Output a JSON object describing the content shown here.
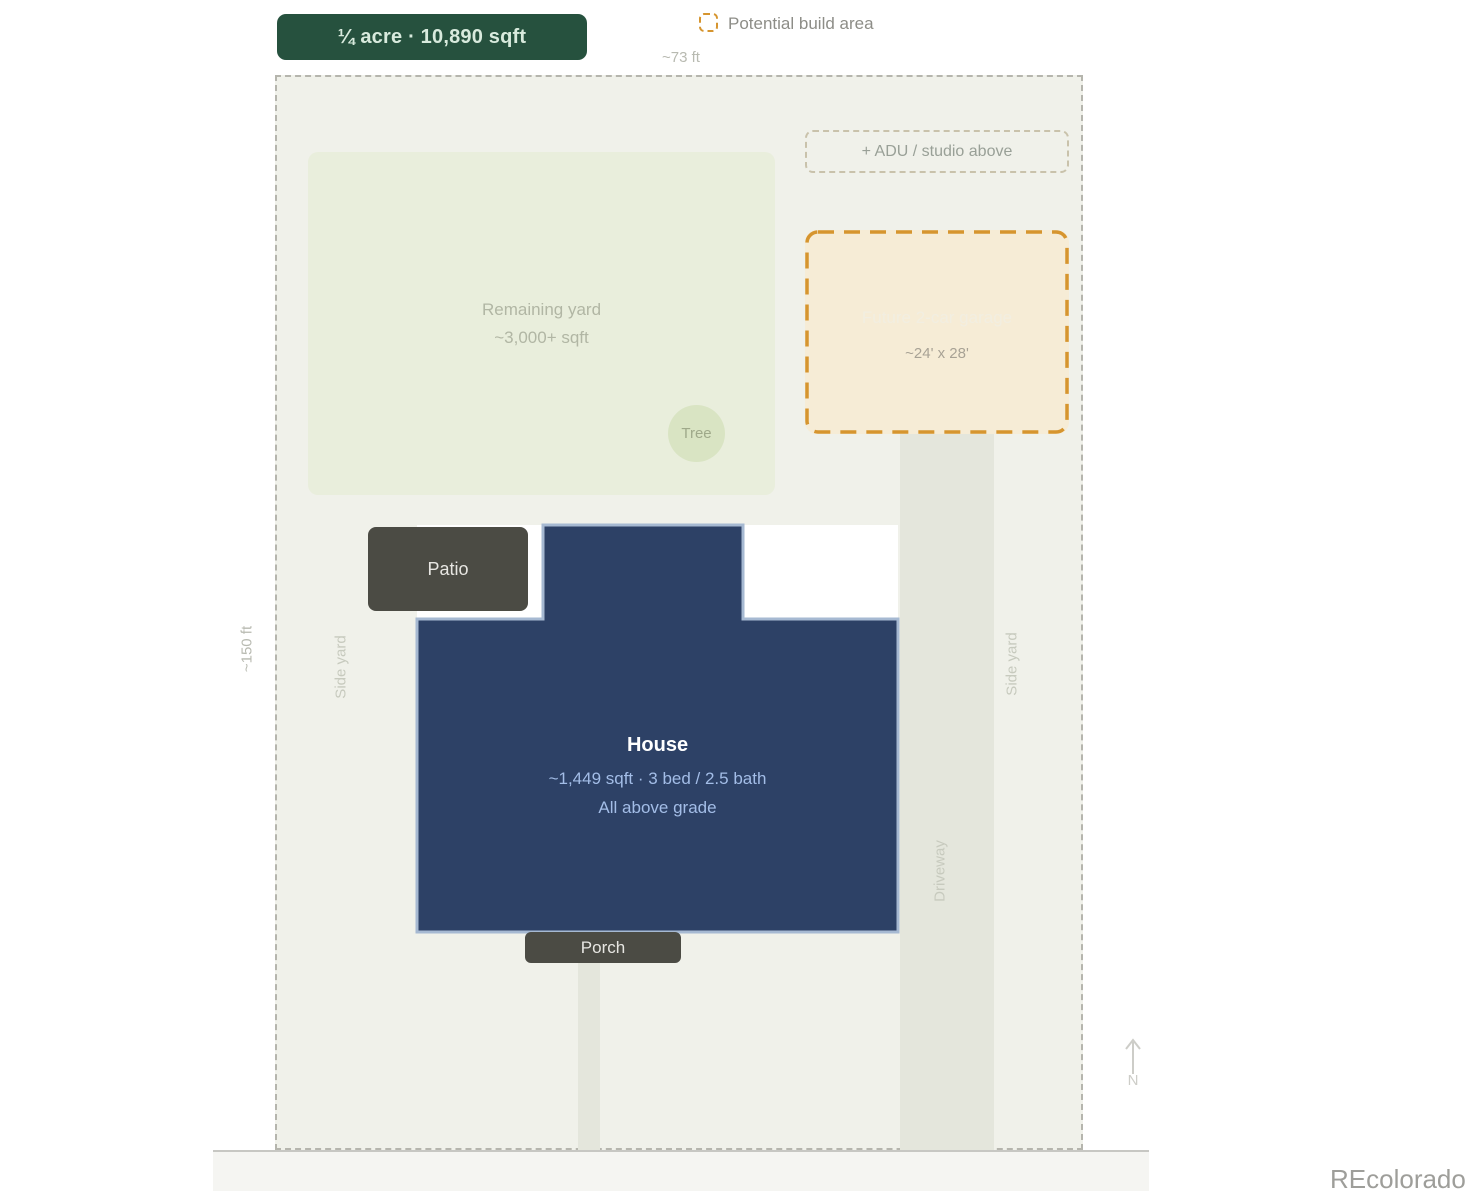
{
  "badge": {
    "label": "¼ acre · 10,890 sqft"
  },
  "legend": {
    "label": "Potential build area"
  },
  "dimensions": {
    "frontage": "~73 ft",
    "depth": "~150 ft"
  },
  "lot": {
    "remaining_yard": {
      "title": "Remaining yard",
      "subtitle": "~3,000+ sqft"
    },
    "tree": {
      "label": "Tree"
    },
    "adu": {
      "label": "+ ADU / studio above"
    },
    "garage": {
      "title": "Future 2-car garage",
      "size": "~24' x 28'"
    },
    "patio": {
      "label": "Patio"
    },
    "house": {
      "title": "House",
      "details": "~1,449 sqft · 3 bed / 2.5 bath",
      "note": "All above grade"
    },
    "porch": {
      "label": "Porch"
    },
    "side_yard_left": "Side yard",
    "side_yard_right": "Side yard",
    "driveway": "Driveway"
  },
  "compass": {
    "label": "N"
  },
  "watermark": "REcolorado",
  "colors": {
    "badge_green": "#26513e",
    "build_area_orange": "#d6952f",
    "house_navy": "#2d4166",
    "house_border_blue": "#a6b9d2",
    "structure_charcoal": "#4b4b44",
    "lot_fill": "#f0f1ea",
    "yard_green": "#e9eedc",
    "garage_tan": "#f6ecd6"
  }
}
